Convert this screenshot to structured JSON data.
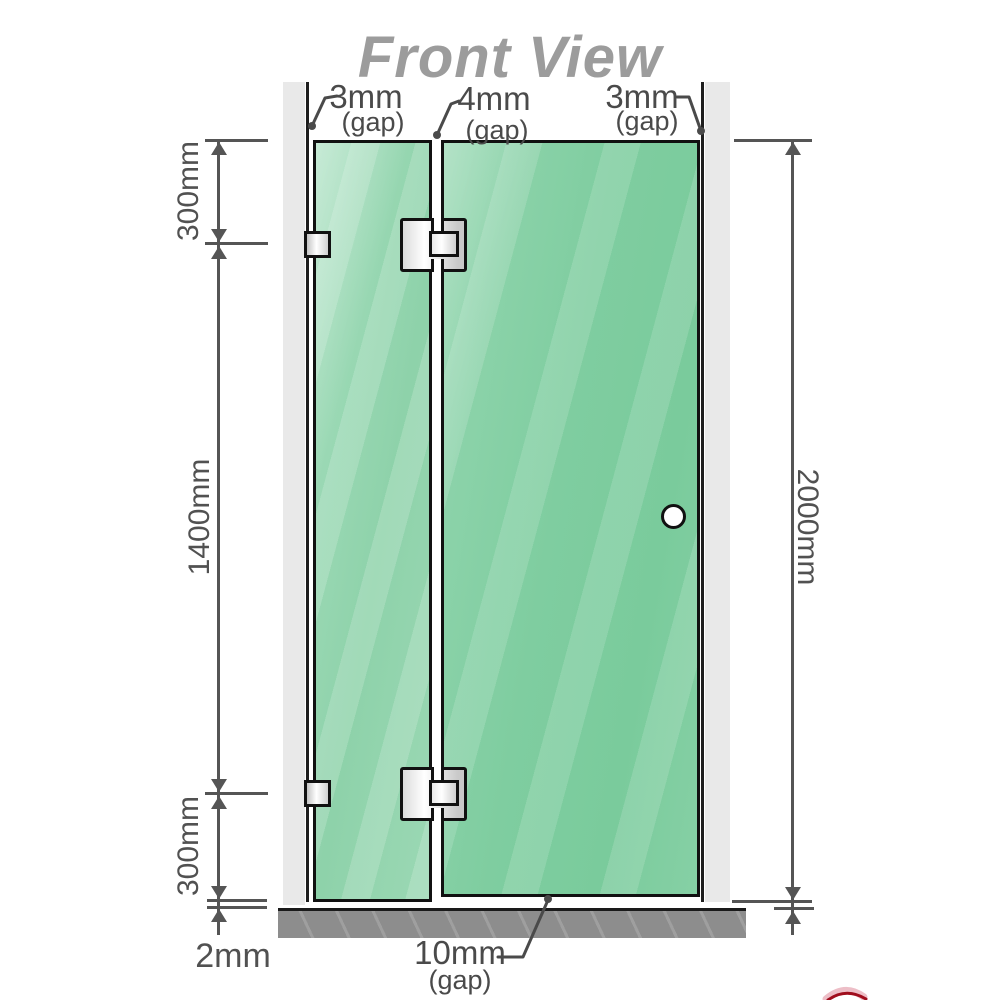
{
  "title": "Front View",
  "top_gap_labels": [
    {
      "value": "3mm",
      "note": "(gap)"
    },
    {
      "value": "4mm",
      "note": "(gap)"
    },
    {
      "value": "3mm",
      "note": "(gap)"
    }
  ],
  "left_dimensions": {
    "top_section": "300mm",
    "middle_section": "1400mm",
    "bottom_section": "300mm",
    "floor_gap": "2mm"
  },
  "right_dimension": {
    "overall_height": "2000mm"
  },
  "bottom_gap": {
    "value": "10mm",
    "note": "(gap)"
  },
  "colors": {
    "glass_green": "#8ed2aa",
    "wall_gray": "#e9e9e9",
    "floor_gray": "#8d8d8d",
    "outline_black": "#111111",
    "dimension_gray": "#555555",
    "title_gray": "#9c9c9c",
    "accent_red": "#a00d1d"
  }
}
